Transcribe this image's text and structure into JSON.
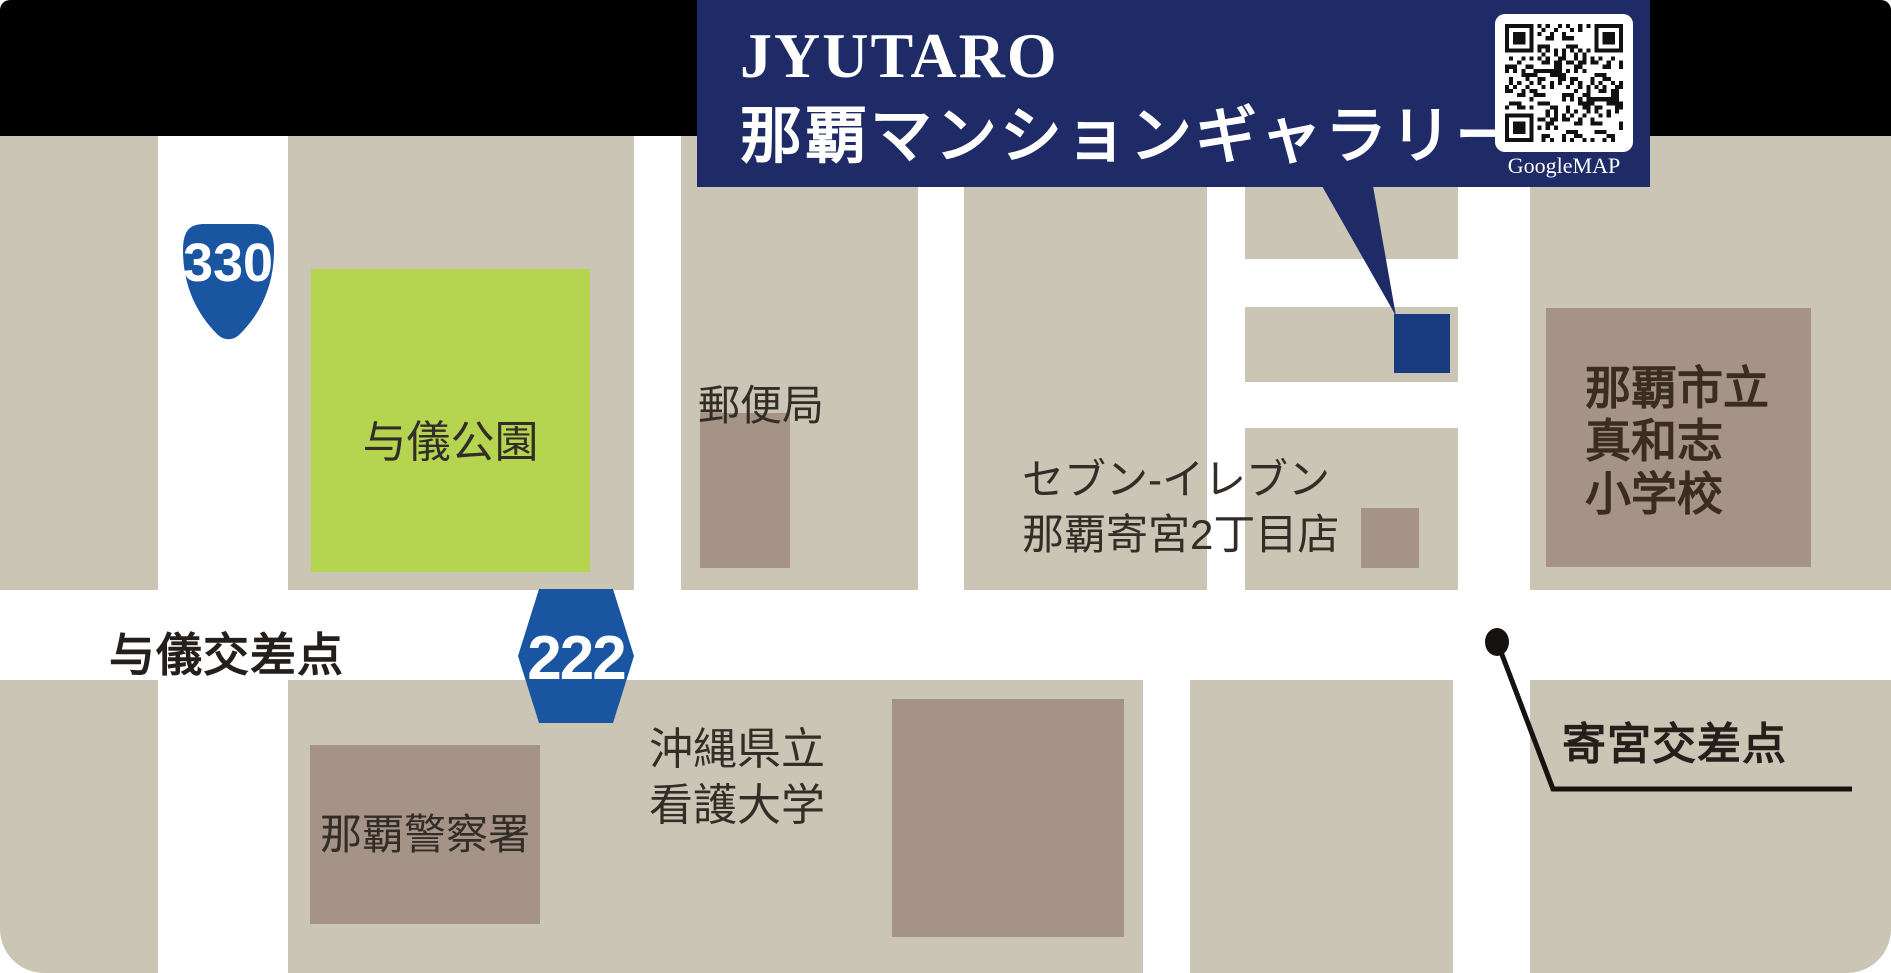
{
  "header": {
    "title_line1": "JYUTARO",
    "title_line2": "那覇マンションギャラリー",
    "qr_label": "GoogleMAP"
  },
  "route_shields": {
    "national_route": "330",
    "prefectural_route": "222"
  },
  "places": {
    "park": "与儀公園",
    "post_office": "郵便局",
    "seven_eleven_line1": "セブン-イレブン",
    "seven_eleven_line2": "那覇寄宮2丁目店",
    "police": "那覇警察署",
    "college_line1": "沖縄県立",
    "college_line2": "看護大学",
    "school_line1": "那覇市立",
    "school_line2": "真和志",
    "school_line3": "小学校"
  },
  "intersections": {
    "yogi": "与儀交差点",
    "yosemiya": "寄宮交差点"
  },
  "colors": {
    "header_navy": "#1e2b66",
    "marker_blue": "#1a3a80",
    "shield_blue": "#1a55a2",
    "block_beige": "#cbc5b5",
    "building_brown": "#a59387",
    "park_green": "#b5d44f",
    "road_white": "#ffffff",
    "line_black": "#151210",
    "top_bar_black": "#000000"
  }
}
